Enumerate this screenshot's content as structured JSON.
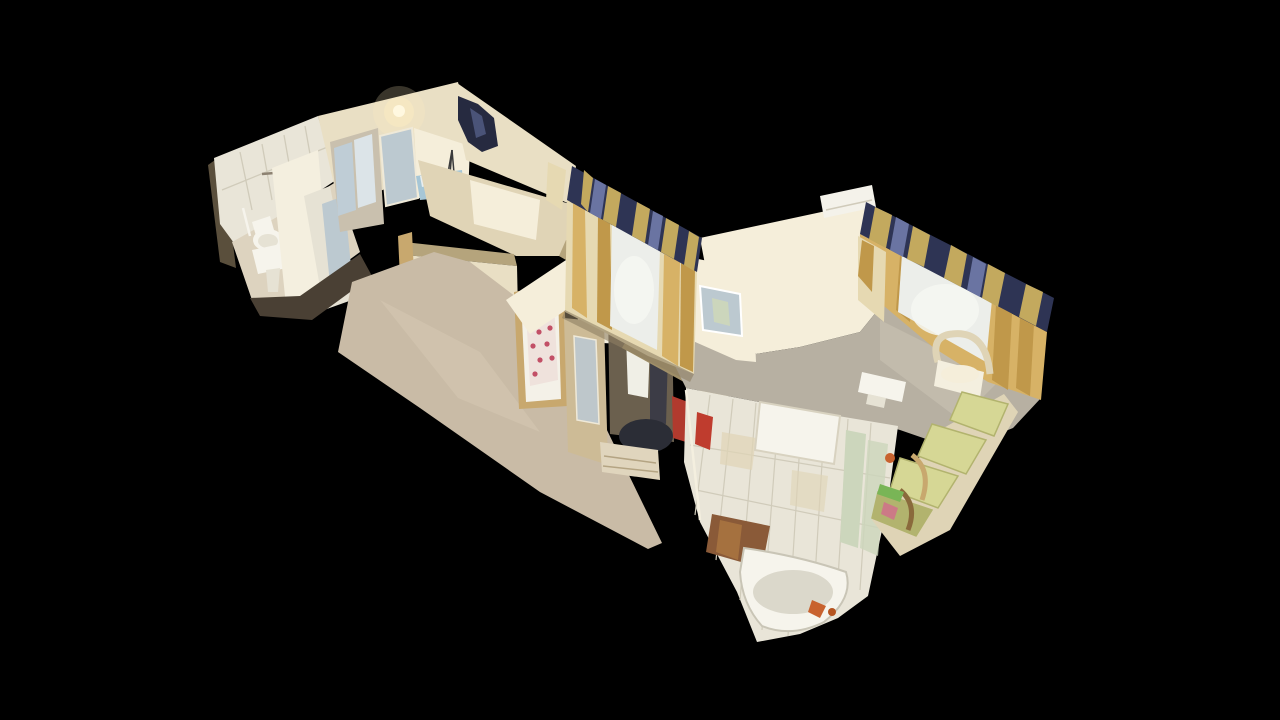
{
  "scene": {
    "type": "3d-dollhouse-view",
    "description": "Cut-away dollhouse view of a scanned apartment seen from above at an oblique angle, floating on a black background: tiled bathroom with toilet and sink at upper left, lit hallway with mirror, bedroom doorway with floral mattress, wardrobe nook with bags and coats, living room with yellow curtains, blue-and-gold valances, air conditioner, armchair and green daybed at right, and a tiled bathroom with bathtub at bottom center.",
    "rooms": [
      "bathroom",
      "hallway",
      "bedroom",
      "corridor",
      "wardrobe-nook",
      "living-room",
      "second-bathroom"
    ],
    "background": "#000000"
  },
  "palette": {
    "background": "#000000",
    "tileWhite": "#e9e5d8",
    "tileGrout": "#d0cbba",
    "tileMint": "#ccd6bc",
    "wallCream": "#e9dfc4",
    "wallBright": "#f5eeda",
    "wallMid": "#e0d4b6",
    "wallInner": "#c9c0ae",
    "wallTan": "#b5a47c",
    "wallKhaki": "#a08f68",
    "wallDark": "#5a4f3c",
    "shadowBrown": "#4a4034",
    "floorHall": "#c9bba6",
    "floorHallHi": "#d6c9b2",
    "floorBath": "#ddd3bf",
    "floorCarpet": "#b7b0a2",
    "floorBright": "#cdc5b5",
    "woodFrame": "#c8a86e",
    "woodDark": "#8a6a3c",
    "doorBright": "#f4efdf",
    "mirrorBlue": "#bcc9d0",
    "glassBlue": "#dce4e8",
    "glassDeep": "#bfcdd6",
    "bedBlue": "#a6c6d6",
    "pillowWhite": "#e8eef0",
    "mattressWhite": "#efe2dc",
    "mattressBase": "#f4f1e8",
    "floralRed": "#c24f66",
    "valanceNavy": "#2e3454",
    "valanceBlue": "#6a74a2",
    "valanceGold": "#c3a95e",
    "curtainGold": "#d7b266",
    "curtainDeep": "#c0984a",
    "curtainPale": "#e6d9b2",
    "sheerWhite": "#eceeea",
    "sheerGlow": "#f6f7f2",
    "glowWarm": "#ffefc0",
    "glowCore": "#fff8e0",
    "acWhite": "#f4f2ea",
    "fixtureWhite": "#f6f4ec",
    "ceramicShadow": "#e6e2d4",
    "darkGarment": "#262a40",
    "garmentHi": "#4a5378",
    "bagDark": "#2b2d36",
    "bagDark2": "#34363f",
    "closetShadow": "#6b604e",
    "coatDark": "#3c3c46",
    "jacketWhite": "#f0efe6",
    "wardrobeWood": "#cdbb96",
    "drawerCream": "#e0d5bd",
    "drawerLine": "#b4a483",
    "redItem": "#b13a2e",
    "redTowel": "#bf3c2e",
    "orange": "#c8622e",
    "orangeDeep": "#b5541f",
    "brownFloor": "#8a5a38",
    "brownHi": "#a5713f",
    "sofaGreen": "#d6d795",
    "sofaGreenDark": "#b2b36e",
    "sofaFrame": "#dfd4b6",
    "grassGreen": "#79b556",
    "pinkClutter": "#cc7a86",
    "tubInner": "#dbd8cb",
    "railGray": "#8d8272",
    "tripodDark": "#3a3a3a",
    "sillShadow": "#8d7f62"
  }
}
